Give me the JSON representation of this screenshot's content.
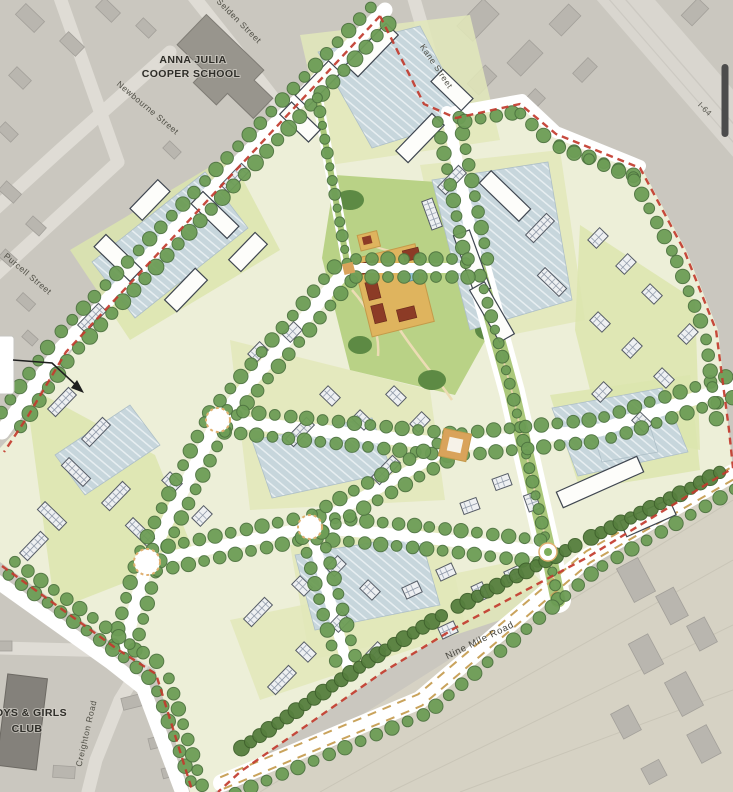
{
  "map": {
    "title_labels": {
      "school_line1": "ANNA JULIA",
      "school_line2": "COOPER SCHOOL",
      "club_line1": "BOYS & GIRLS",
      "club_line2": "CLUB"
    },
    "street_labels": {
      "selden": "Selden Street",
      "newbourne": "Newbourne Street",
      "purcell": "Purcell Street",
      "kane": "Kane Street",
      "i64": "I-64",
      "nine_mile": "Nine Mile Road",
      "creighton": "Creighton Road"
    },
    "colors": {
      "aerial_base": "#cac7bf",
      "aerial_road": "#dfdcd5",
      "site_base": "#edefd8",
      "tree_green": "#6d9d56",
      "park_green": "#b9d286",
      "parking_blue": "#c7d6dc",
      "boundary_red": "#c23b2e",
      "plaza_tan": "#dfb45e",
      "pool_blue": "#8fc3d4",
      "scrollbar": "#4c4c4c"
    }
  },
  "viewer": {
    "has_scrollbar": true
  }
}
